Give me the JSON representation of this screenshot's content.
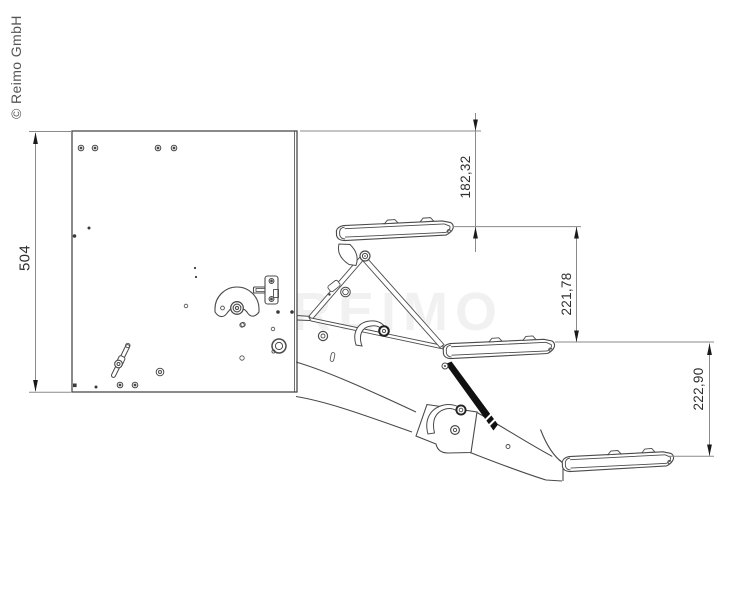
{
  "page": {
    "background": "#ffffff",
    "copyright": "© Reimo GmbH",
    "watermark": "REIMO"
  },
  "drawing": {
    "type": "technical-line-drawing",
    "subject": "fold-out triple entry step, side view",
    "line_color": "#4a4a4a",
    "dimension_line_color": "#8a8a8a",
    "arrow_color": "#1a1a1a",
    "text_color": "#2f2f2f"
  },
  "dimensions": {
    "overall_height": {
      "label": "504",
      "side": "left",
      "orientation": "vertical"
    },
    "step1_drop": {
      "label": "182,32",
      "side": "right",
      "orientation": "vertical"
    },
    "step2_drop": {
      "label": "221,78",
      "side": "right",
      "orientation": "vertical"
    },
    "step3_drop": {
      "label": "222,90",
      "side": "right",
      "orientation": "vertical"
    }
  }
}
